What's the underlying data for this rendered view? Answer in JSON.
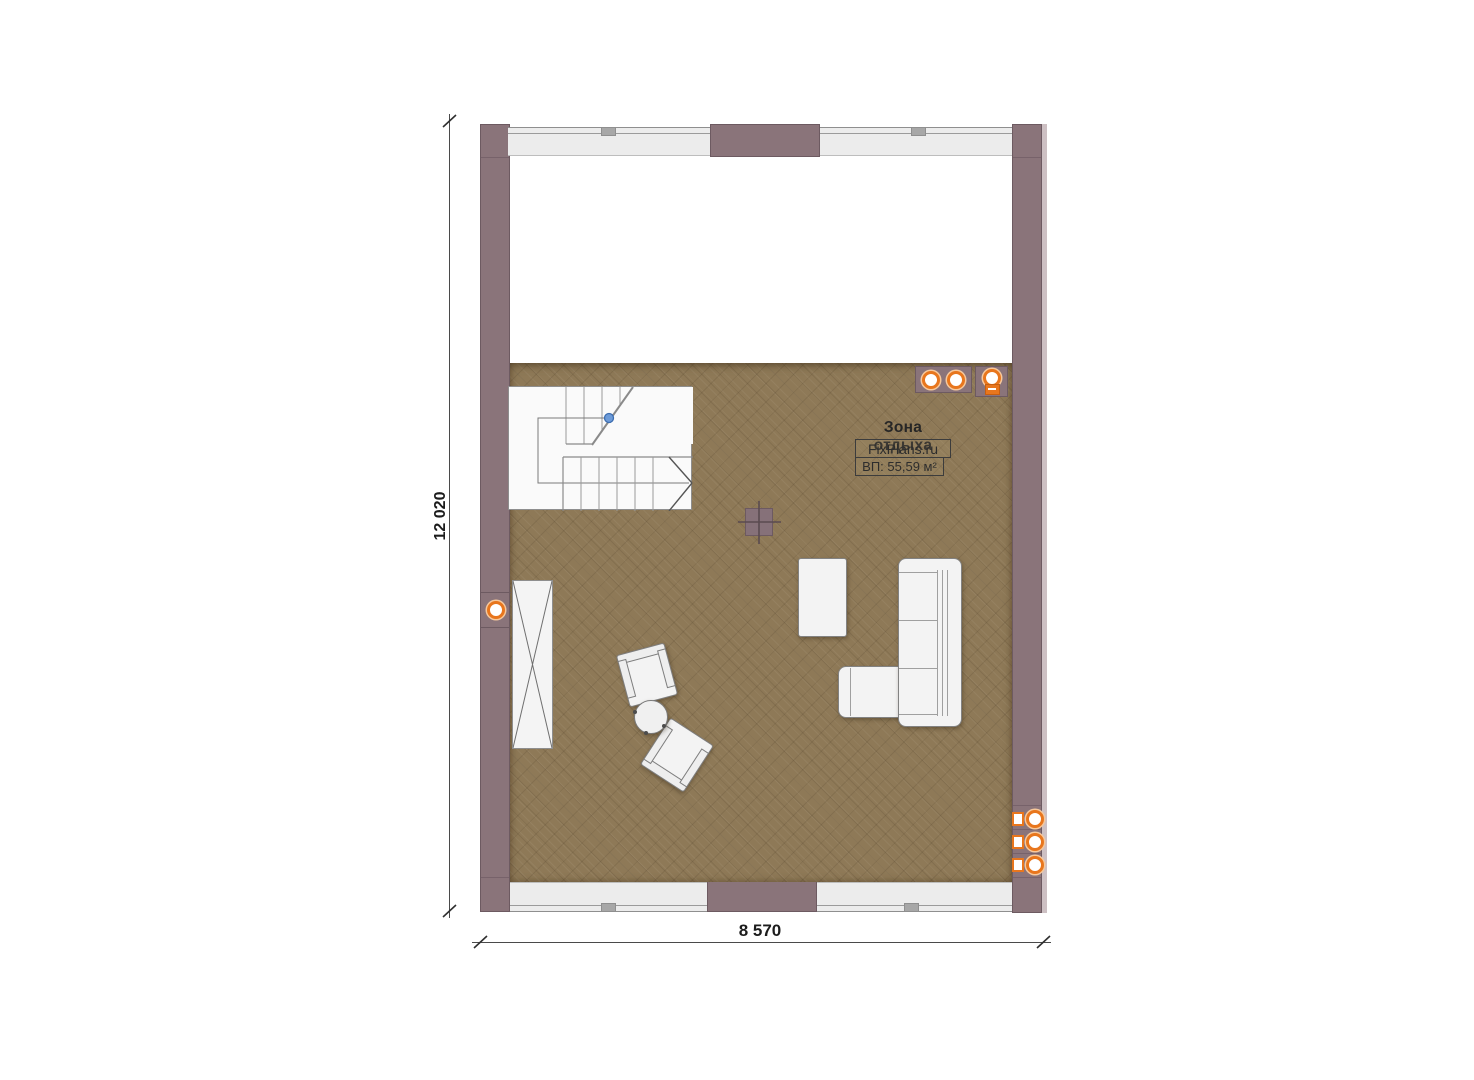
{
  "plan": {
    "type": "floor-plan",
    "zone_label": "Зона отдыха",
    "brand": "FixPlans.ru",
    "area_label": "ВП: 55,59 м²",
    "room": {
      "name": "Зона отдыха",
      "area_value": "55,59",
      "area_unit": "м²"
    },
    "dimensions": {
      "height_label": "12 020",
      "width_label": "8 570"
    },
    "furniture": [
      "staircase-u-turn",
      "wardrobe-with-x",
      "corner-sofa",
      "sofa-chaise",
      "coffee-table",
      "armchair",
      "armchair",
      "round-side-table",
      "chimney-flue"
    ],
    "lighting": {
      "ceiling_spotlights": 3,
      "wall_lamps": 1,
      "sconces": 3
    },
    "stair": {
      "flights": 2,
      "start_marker": "blue-dot",
      "direction_arrow": "right"
    },
    "colors": {
      "wall": "#8a747a",
      "wall_outline": "#6d5a61",
      "floor": "#8e7957",
      "glass_band": "#ececec",
      "accent_orange": "#e8761d",
      "stair_marker_blue": "#6d9bd8",
      "furniture_fill": "#f3f3f3",
      "dimension_text": "#1c1c1c"
    }
  }
}
